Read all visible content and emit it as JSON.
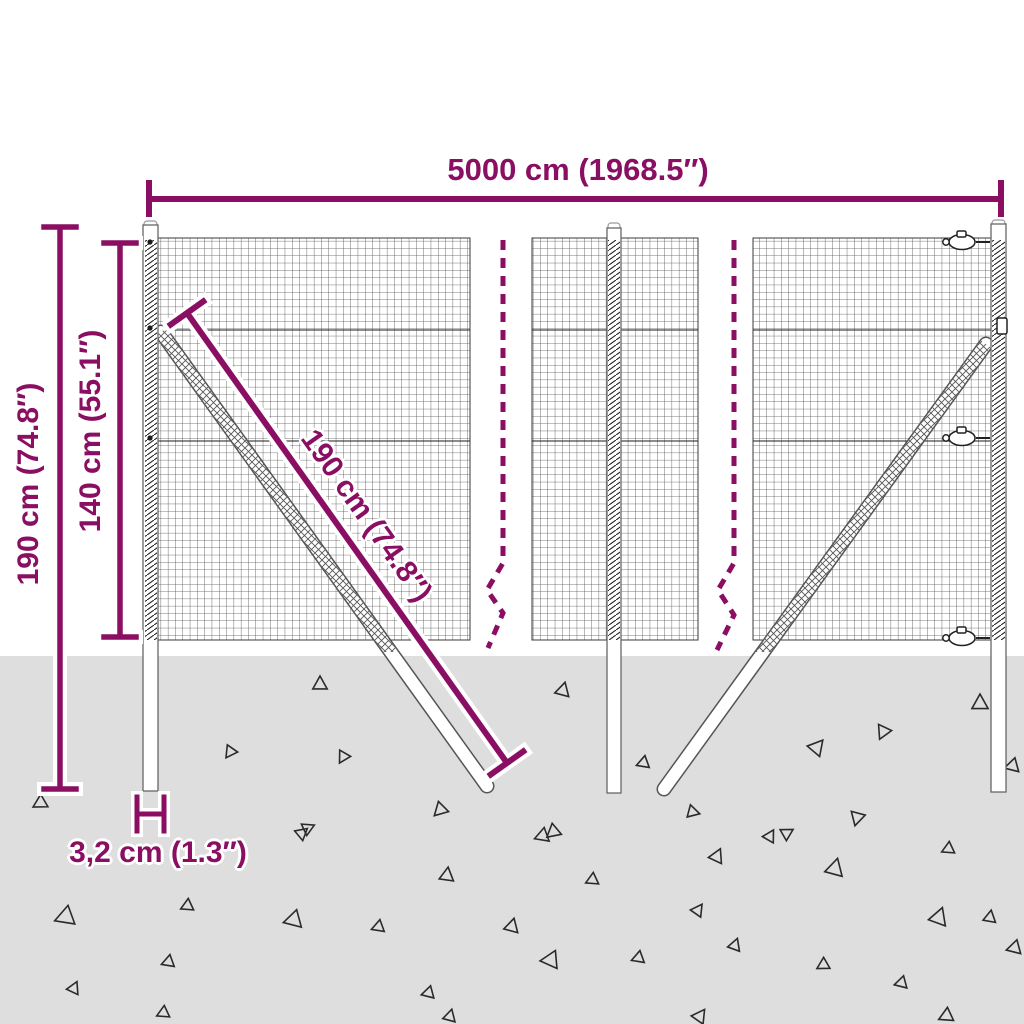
{
  "colors": {
    "accent": "#8a0e62",
    "ground": "#dedede",
    "line": "#2a2a2a"
  },
  "dimensions": {
    "total_width": "5000 cm (1968.5″)",
    "total_height": "190 cm (74.8″)",
    "mesh_height": "140 cm (55.1″)",
    "post_length": "190 cm (74.8″)",
    "post_thickness": "3,2 cm (1.3″)"
  },
  "decor": {
    "triangles": [
      [
        320,
        684,
        8,
        0
      ],
      [
        563,
        690,
        8,
        15
      ],
      [
        230,
        752,
        7,
        215
      ],
      [
        343,
        757,
        7,
        210
      ],
      [
        643,
        763,
        7,
        250
      ],
      [
        40,
        803,
        8,
        240
      ],
      [
        308,
        828,
        7,
        65
      ],
      [
        440,
        810,
        8,
        225
      ],
      [
        553,
        832,
        8,
        230
      ],
      [
        693,
        812,
        7,
        105
      ],
      [
        787,
        833,
        7,
        60
      ],
      [
        817,
        747,
        9,
        40
      ],
      [
        883,
        732,
        8,
        205
      ],
      [
        980,
        703,
        9,
        0
      ],
      [
        857,
        818,
        8,
        195
      ],
      [
        1012,
        766,
        8,
        255
      ],
      [
        65,
        917,
        11,
        250
      ],
      [
        187,
        906,
        7,
        245
      ],
      [
        168,
        962,
        7,
        250
      ],
      [
        74,
        988,
        7,
        25
      ],
      [
        293,
        920,
        10,
        255
      ],
      [
        378,
        927,
        7,
        250
      ],
      [
        447,
        875,
        8,
        8
      ],
      [
        428,
        993,
        7,
        255
      ],
      [
        592,
        880,
        7,
        245
      ],
      [
        717,
        856,
        8,
        25
      ],
      [
        698,
        910,
        7,
        35
      ],
      [
        512,
        926,
        8,
        15
      ],
      [
        550,
        960,
        10,
        265
      ],
      [
        638,
        958,
        7,
        250
      ],
      [
        735,
        945,
        7,
        20
      ],
      [
        835,
        868,
        10,
        15
      ],
      [
        823,
        965,
        7,
        240
      ],
      [
        901,
        983,
        7,
        255
      ],
      [
        948,
        849,
        7,
        245
      ],
      [
        939,
        917,
        10,
        20
      ],
      [
        990,
        917,
        7,
        10
      ],
      [
        1014,
        948,
        8,
        255
      ],
      [
        163,
        1013,
        7,
        245
      ],
      [
        450,
        1016,
        7,
        15
      ],
      [
        700,
        1016,
        8,
        35
      ],
      [
        946,
        1016,
        8,
        245
      ],
      [
        302,
        833,
        7,
        50
      ],
      [
        542,
        836,
        8,
        250
      ],
      [
        770,
        836,
        7,
        30
      ]
    ]
  }
}
